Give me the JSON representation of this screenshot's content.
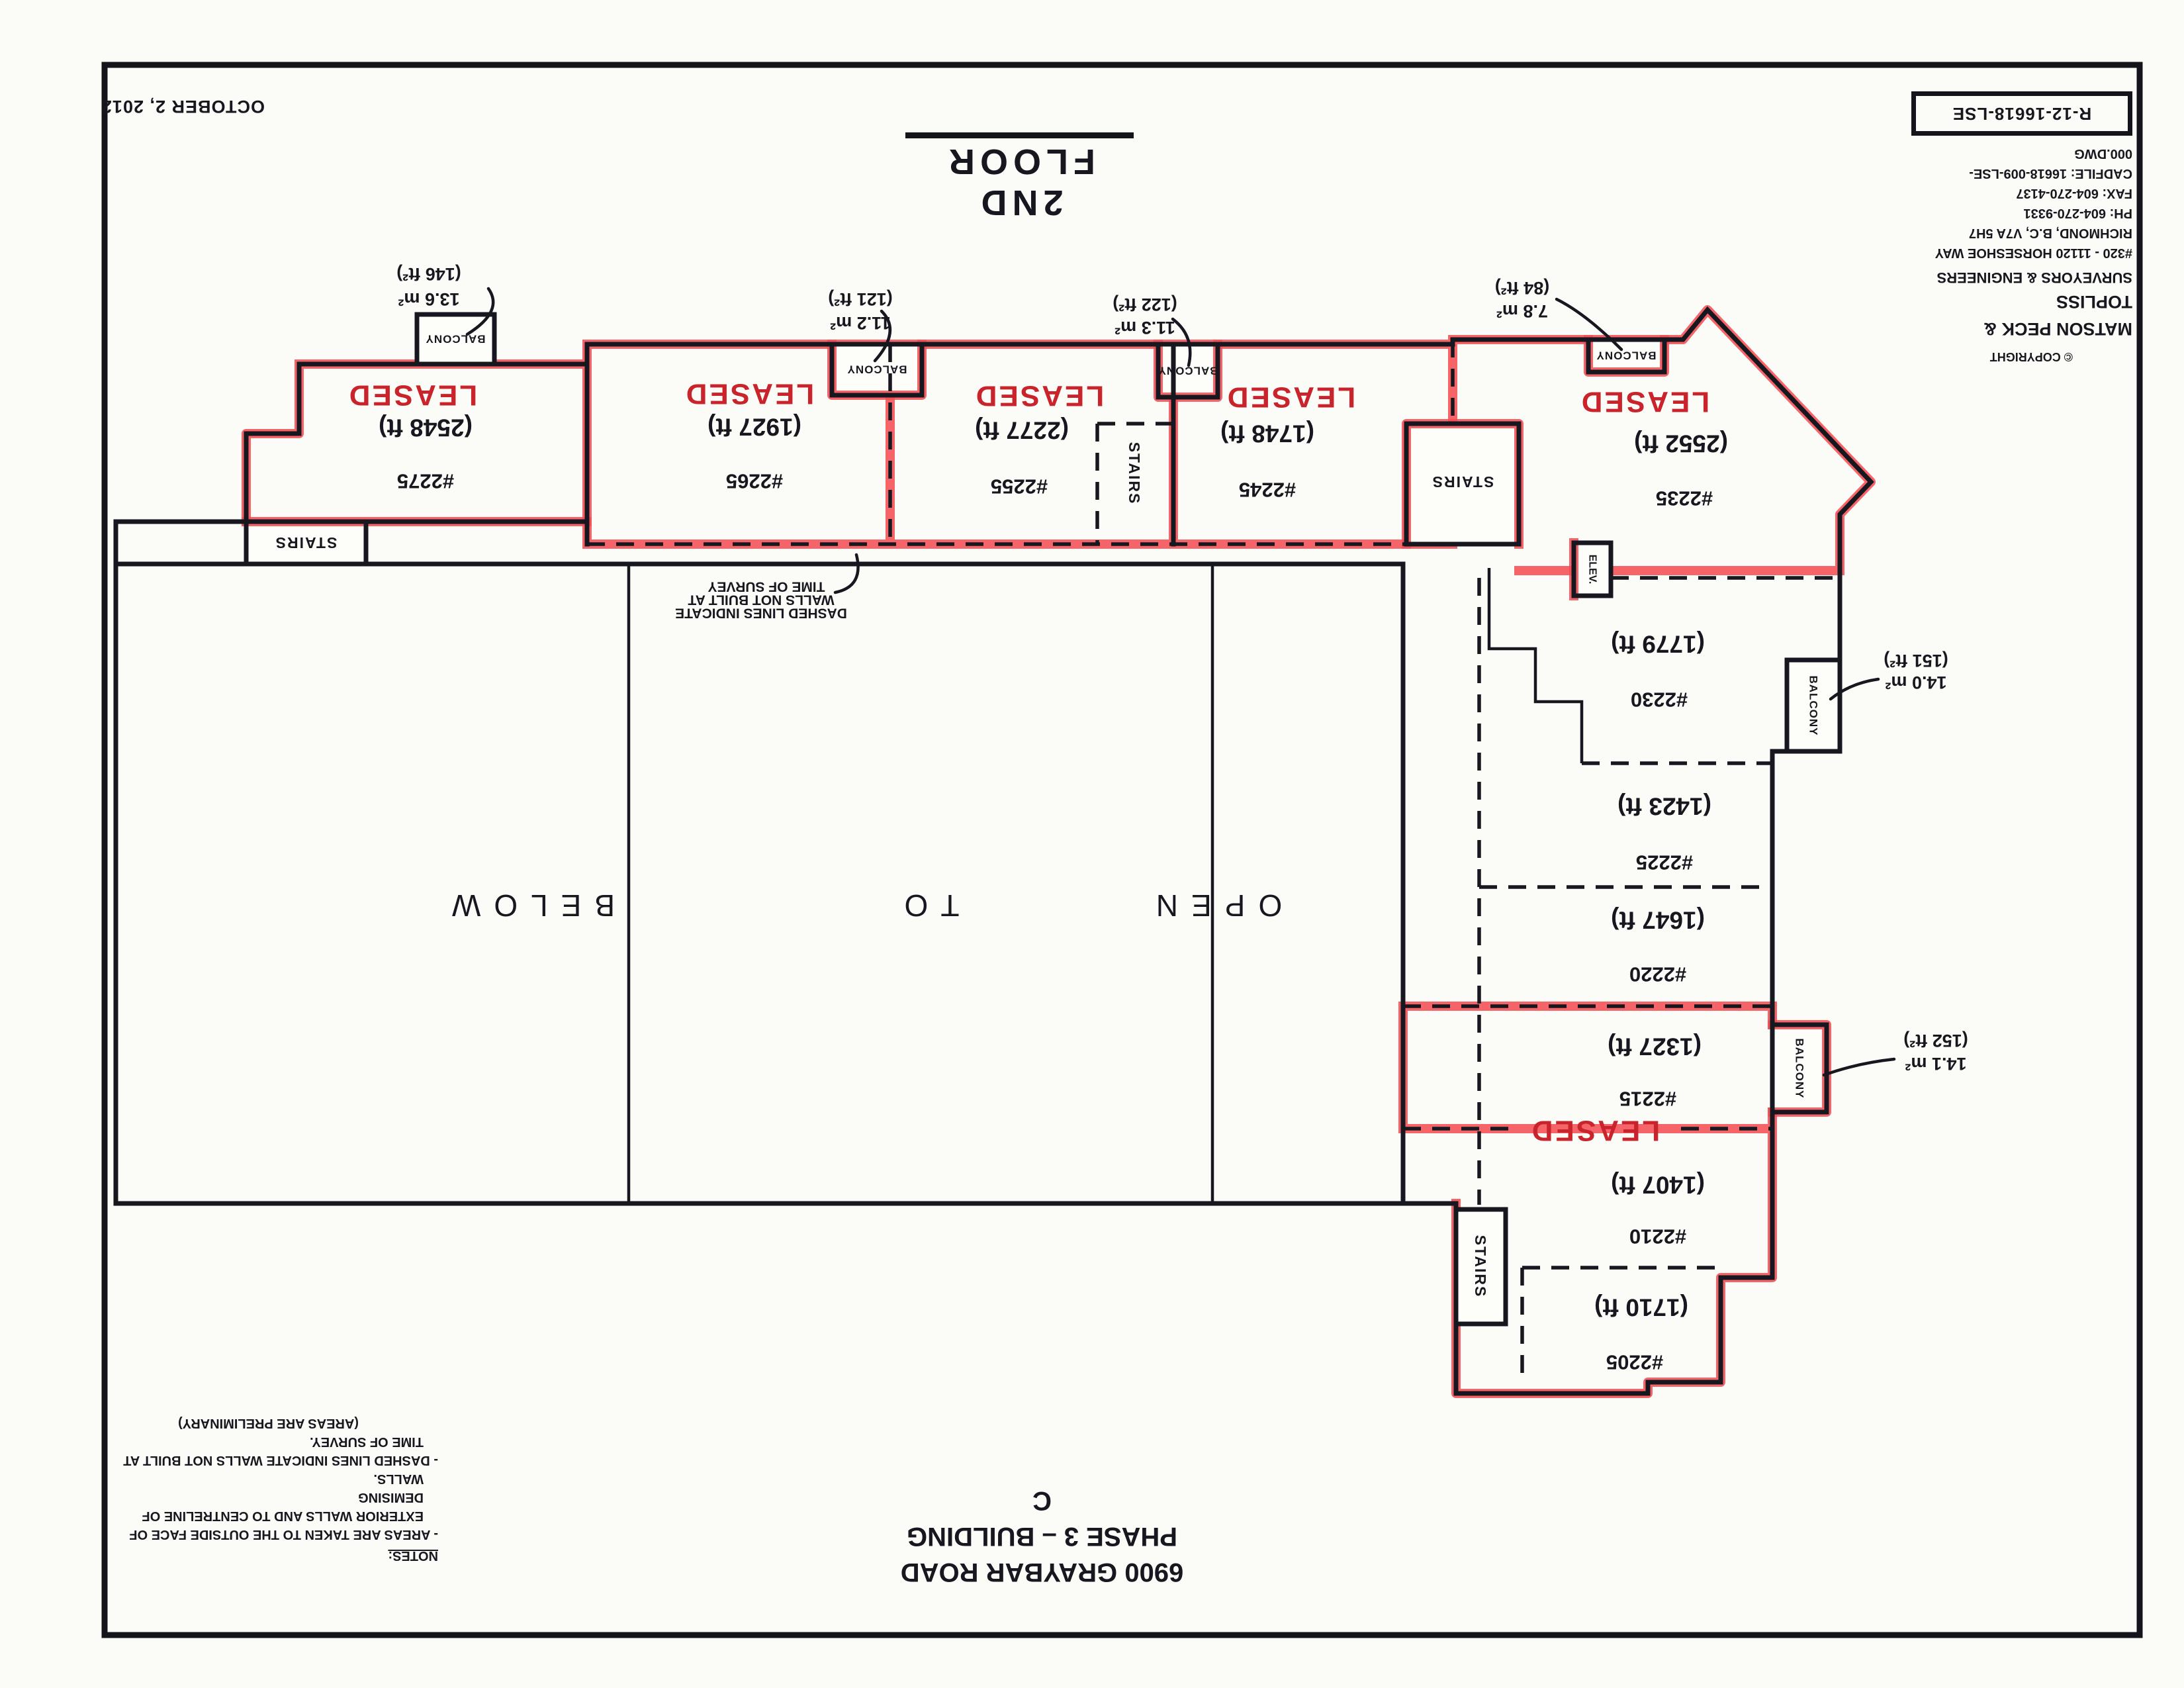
{
  "page": {
    "date": "OCTOBER 2, 2012",
    "floor_title": "2ND FLOOR"
  },
  "title_block": {
    "copyright": "© COPYRIGHT",
    "company": "MATSON PECK & TOPLISS",
    "subtitle": "SURVEYORS & ENGINEERS",
    "address1": "#320 - 11120 HORSESHOE WAY",
    "address2": "RICHMOND, B.C, V7A 5H7",
    "phone": "PH: 604-270-9331",
    "fax": "FAX: 604-270-4137",
    "cadfile": "CADFILE: 16618-009-LSE-000.DWG",
    "drawing_no": "R-12-16618-LSE"
  },
  "address_block": {
    "line1": "6900 GRAYBAR ROAD",
    "line2": "PHASE 3 – BUILDING C"
  },
  "notes": {
    "heading": "NOTES:",
    "line1": "- AREAS ARE TAKEN TO THE OUTSIDE FACE OF",
    "line2": "EXTERIOR WALLS AND TO CENTRELINE OF DEMISING",
    "line3": "WALLS.",
    "line4": "- DASHED LINES INDICATE WALLS NOT BUILT AT",
    "line5": "TIME OF SURVEY.",
    "line6": "(AREAS ARE PRELIMINARY)"
  },
  "plan": {
    "leased": "LEASED",
    "stairs": "STAIRS",
    "elev": "ELEV.",
    "balcony": "BALCONY",
    "open_label": {
      "w1": "OPEN",
      "w2": "TO",
      "w3": "BELOW"
    },
    "survey_note": {
      "l1": "DASHED LINES INDICATE",
      "l2": "WALLS NOT BUILT AT",
      "l3": "TIME OF SURVEY"
    },
    "units": [
      {
        "number": "#2275",
        "area": "(2548 ft)",
        "status": "LEASED"
      },
      {
        "number": "#2265",
        "area": "(1927 ft)",
        "status": "LEASED"
      },
      {
        "number": "#2255",
        "area": "(2277 ft)",
        "status": "LEASED"
      },
      {
        "number": "#2245",
        "area": "(1748 ft)",
        "status": "LEASED"
      },
      {
        "number": "#2235",
        "area": "(2552 ft)",
        "status": "LEASED"
      },
      {
        "number": "#2230",
        "area": "(1779 ft)",
        "status": ""
      },
      {
        "number": "#2225",
        "area": "(1423 ft)",
        "status": ""
      },
      {
        "number": "#2220",
        "area": "(1647 ft)",
        "status": ""
      },
      {
        "number": "#2215",
        "area": "(1327 ft)",
        "status": "LEASED"
      },
      {
        "number": "#2210",
        "area": "(1407 ft)",
        "status": ""
      },
      {
        "number": "#2205",
        "area": "(1710 ft)",
        "status": ""
      }
    ],
    "balcony_areas": [
      {
        "m2": "13.6 m²",
        "ft2": "(146 ft²)"
      },
      {
        "m2": "11.2 m²",
        "ft2": "(121 ft²)"
      },
      {
        "m2": "11.3 m²",
        "ft2": "(122 ft²)"
      },
      {
        "m2": "7.8 m²",
        "ft2": "(84 ft²)"
      },
      {
        "m2": "14.0 m²",
        "ft2": "(151 ft²)"
      },
      {
        "m2": "14.1 m²",
        "ft2": "(152 ft²)"
      }
    ]
  },
  "colors": {
    "ink": "#17171f",
    "leased_text": "#c9232b",
    "highlight": "#f24e54",
    "paper": "#fbfbf7"
  }
}
